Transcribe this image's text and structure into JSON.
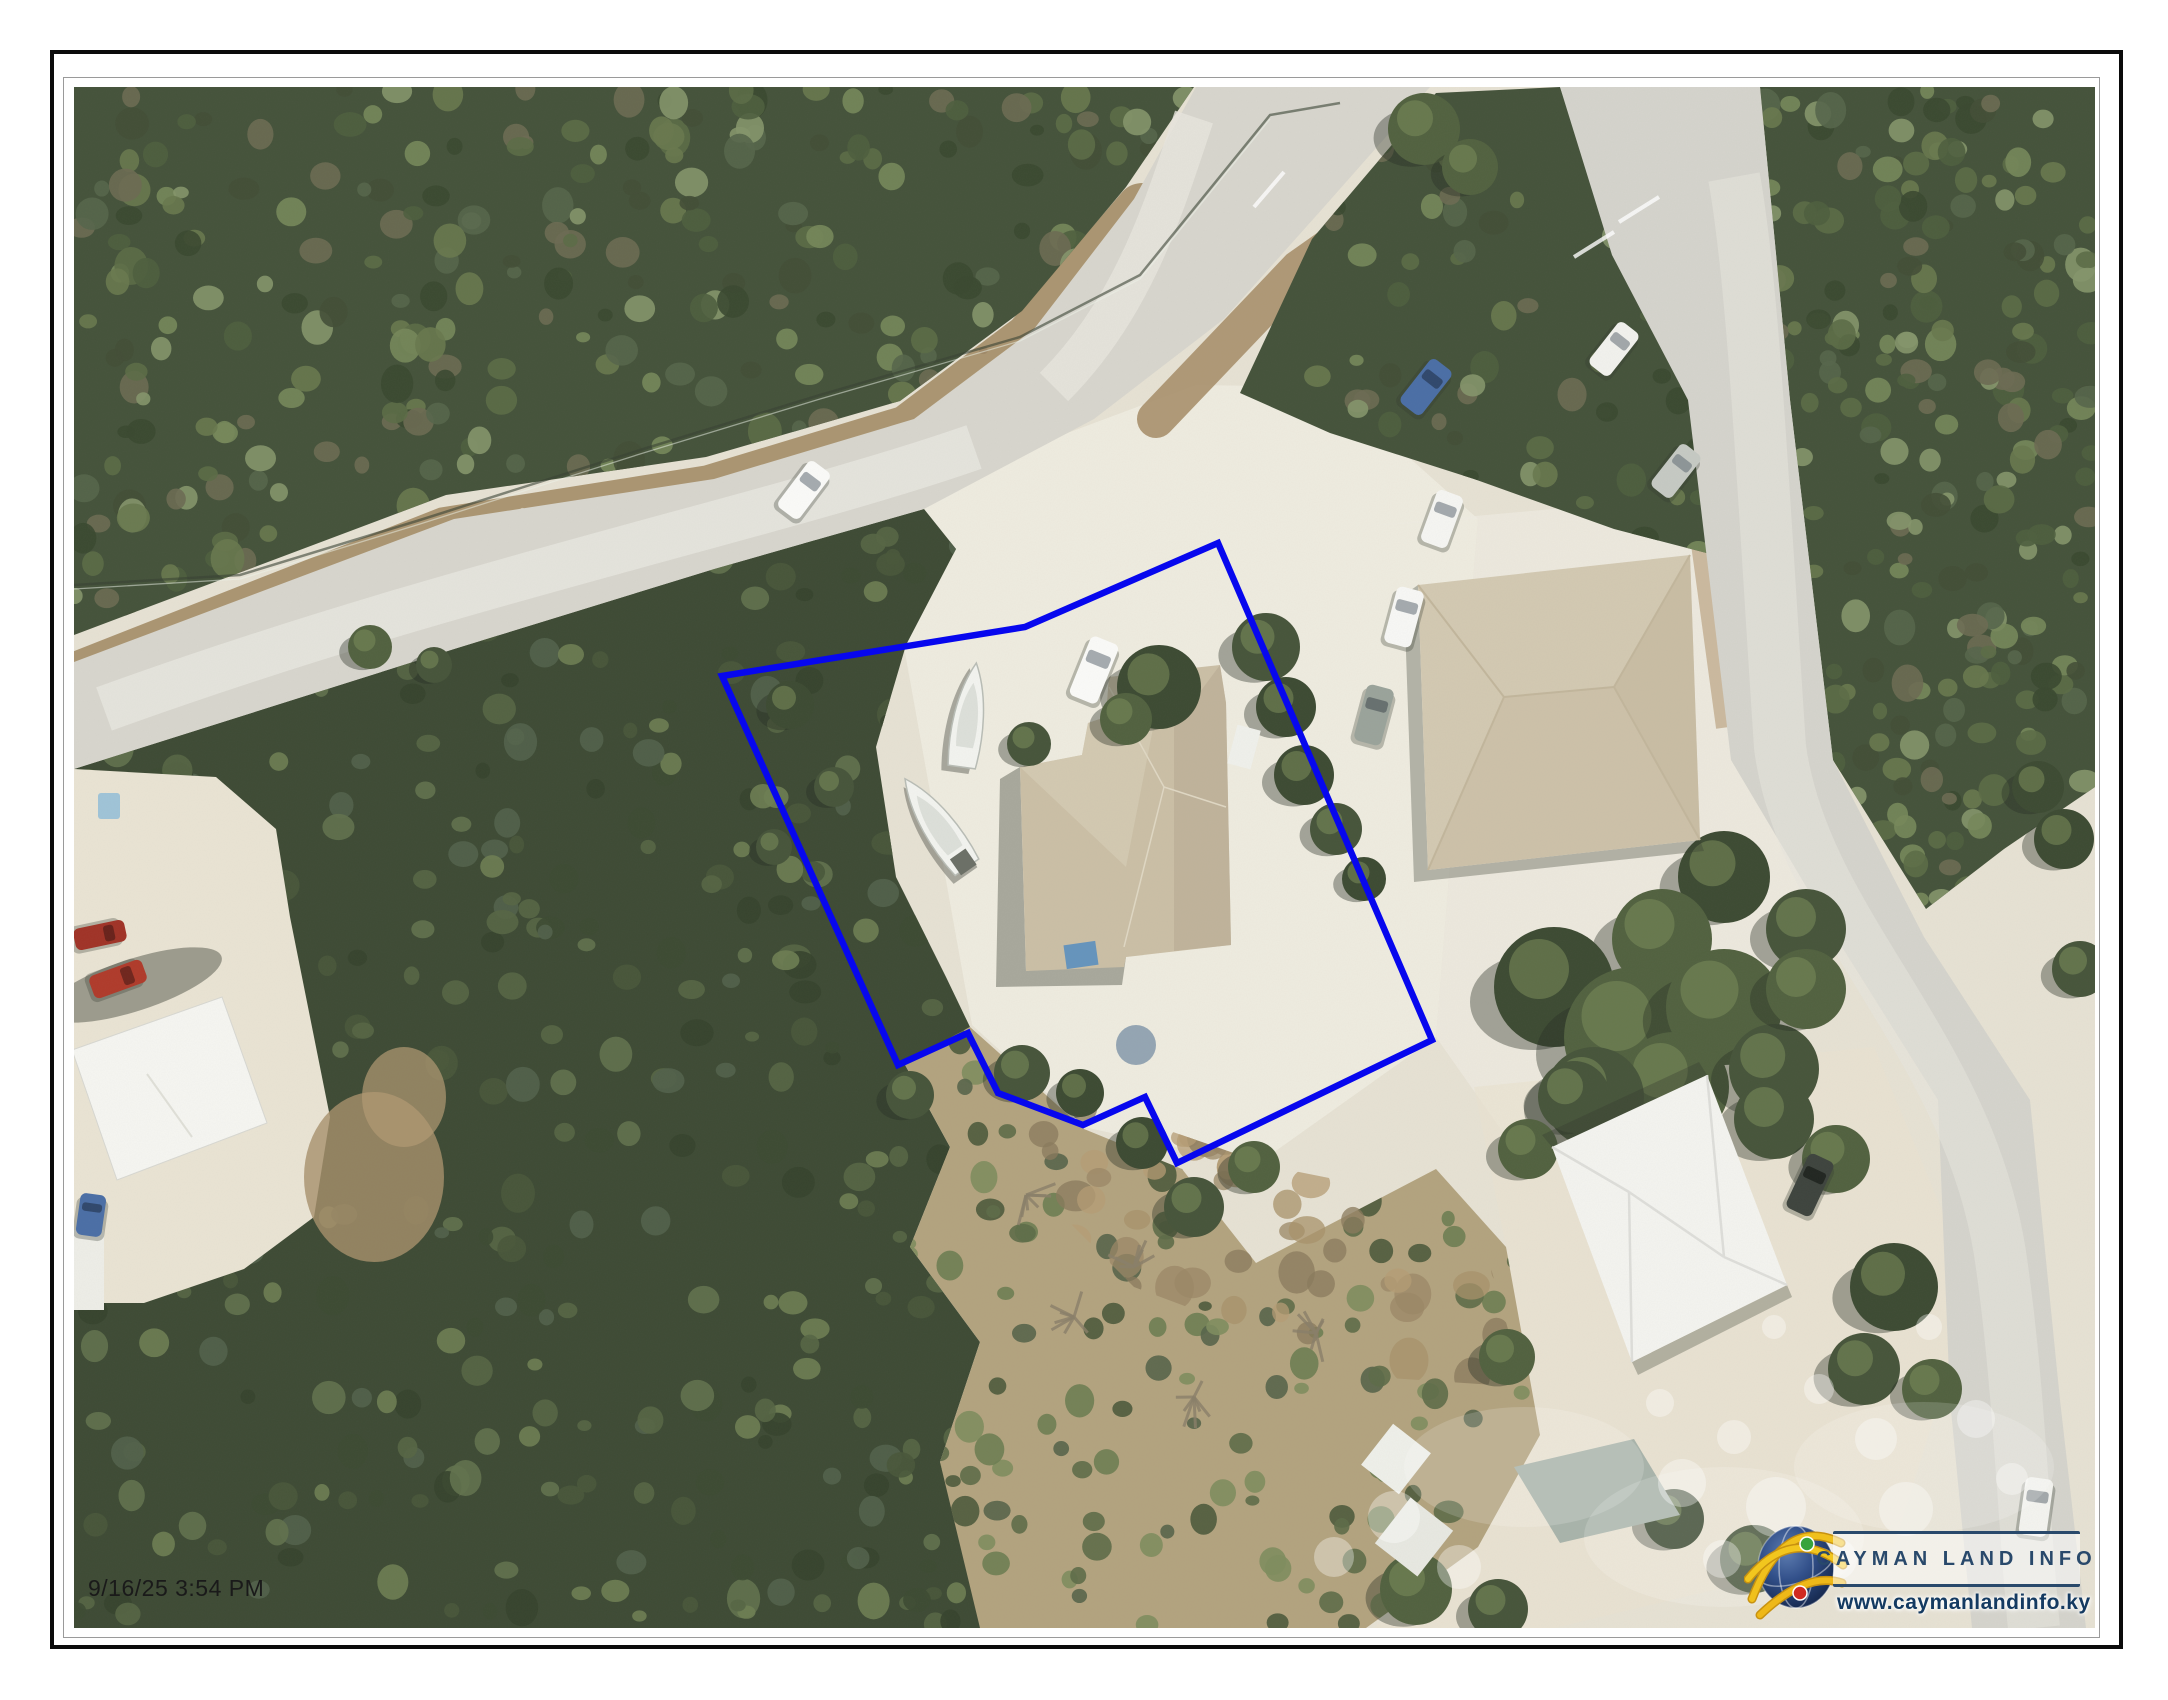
{
  "map": {
    "timestamp": "9/16/25 3:54 PM",
    "description": "aerial-photo-parcel-map"
  },
  "logo": {
    "title": "CAYMAN LAND INFO",
    "url": "www.caymanlandinfo.ky"
  },
  "parcel": {
    "points": "648,589 951,540 1144,456 1358,953 1103,1076 1071,1010 1009,1038 924,1006 894,946 824,978",
    "color": "#0707ee",
    "width": "6.5"
  },
  "colors": {
    "navy": "#29496b",
    "url_navy": "#143a61",
    "parcel_blue": "#0707ee",
    "sand": "#e7e2d4",
    "sand_bright": "#f0ede2",
    "road": "#d8d6ce",
    "road_highlight": "#e8e6df",
    "forest": "#44523a",
    "forest_dark": "#3d4a34",
    "dirt": "#a8906c",
    "roof_tan": "#cbbfa6",
    "roof_neighbor": "#d3c9b2",
    "building_white": "#f4f4f0",
    "arc_yellow": "#f0c01c",
    "globe_blue": "#2c4579",
    "dot_green": "#36a33c",
    "dot_red": "#d02a22",
    "timestamp_ink": "#1a1a1a"
  }
}
